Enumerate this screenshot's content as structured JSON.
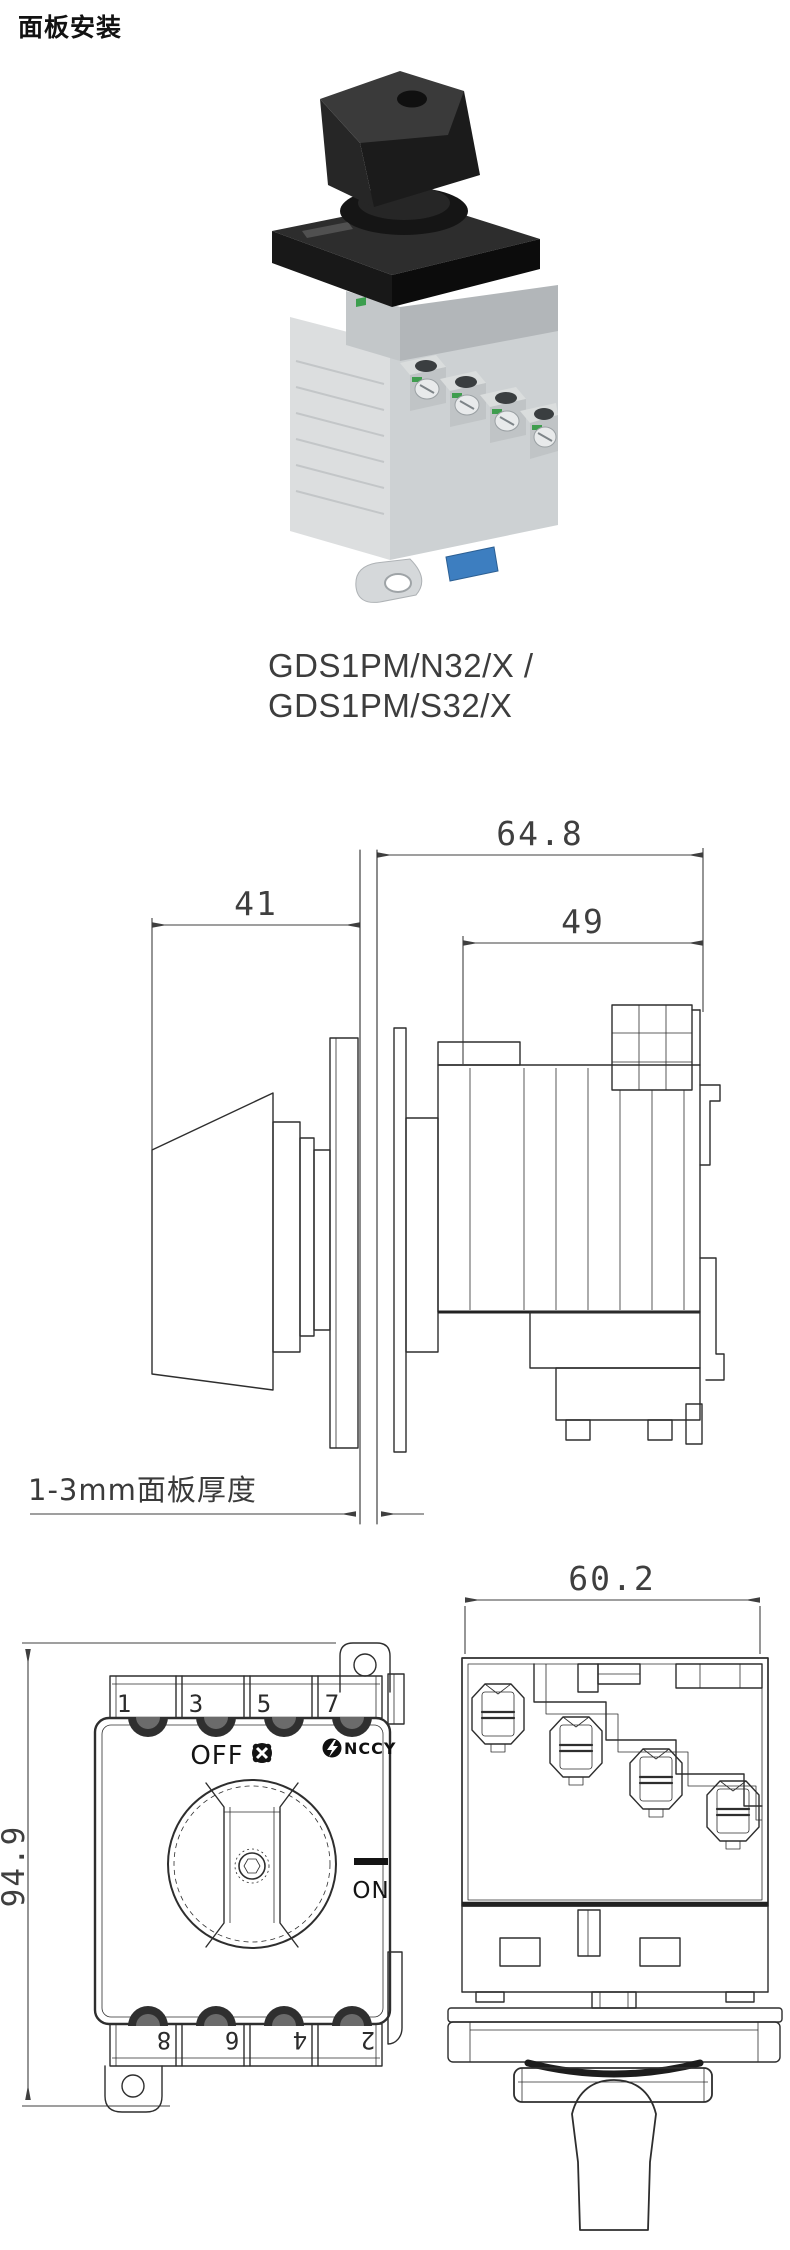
{
  "page": {
    "title": "面板安装"
  },
  "product": {
    "model_line1": "GDS1PM/N32/X /",
    "model_line2": "GDS1PM/S32/X"
  },
  "side_view": {
    "dim_total_depth": "64.8",
    "dim_knob_depth": "41",
    "dim_body_depth": "49",
    "panel_note": "1-3mm面板厚度"
  },
  "front_view": {
    "dim_height": "94.9",
    "off_label": "OFF",
    "on_label": "ON",
    "brand_text": "NCCY",
    "top_terminals": [
      "1",
      "3",
      "5",
      "7"
    ],
    "bottom_terminals": [
      "8",
      "6",
      "4",
      "2"
    ]
  },
  "rear_view": {
    "dim_width": "60.2"
  },
  "colors": {
    "line": "#2e2e2e",
    "dim_text": "#3f3f3f",
    "knob_dark": "#262626",
    "body_gray": "#d3d6d8",
    "clip_blue": "#3d7ec0"
  }
}
